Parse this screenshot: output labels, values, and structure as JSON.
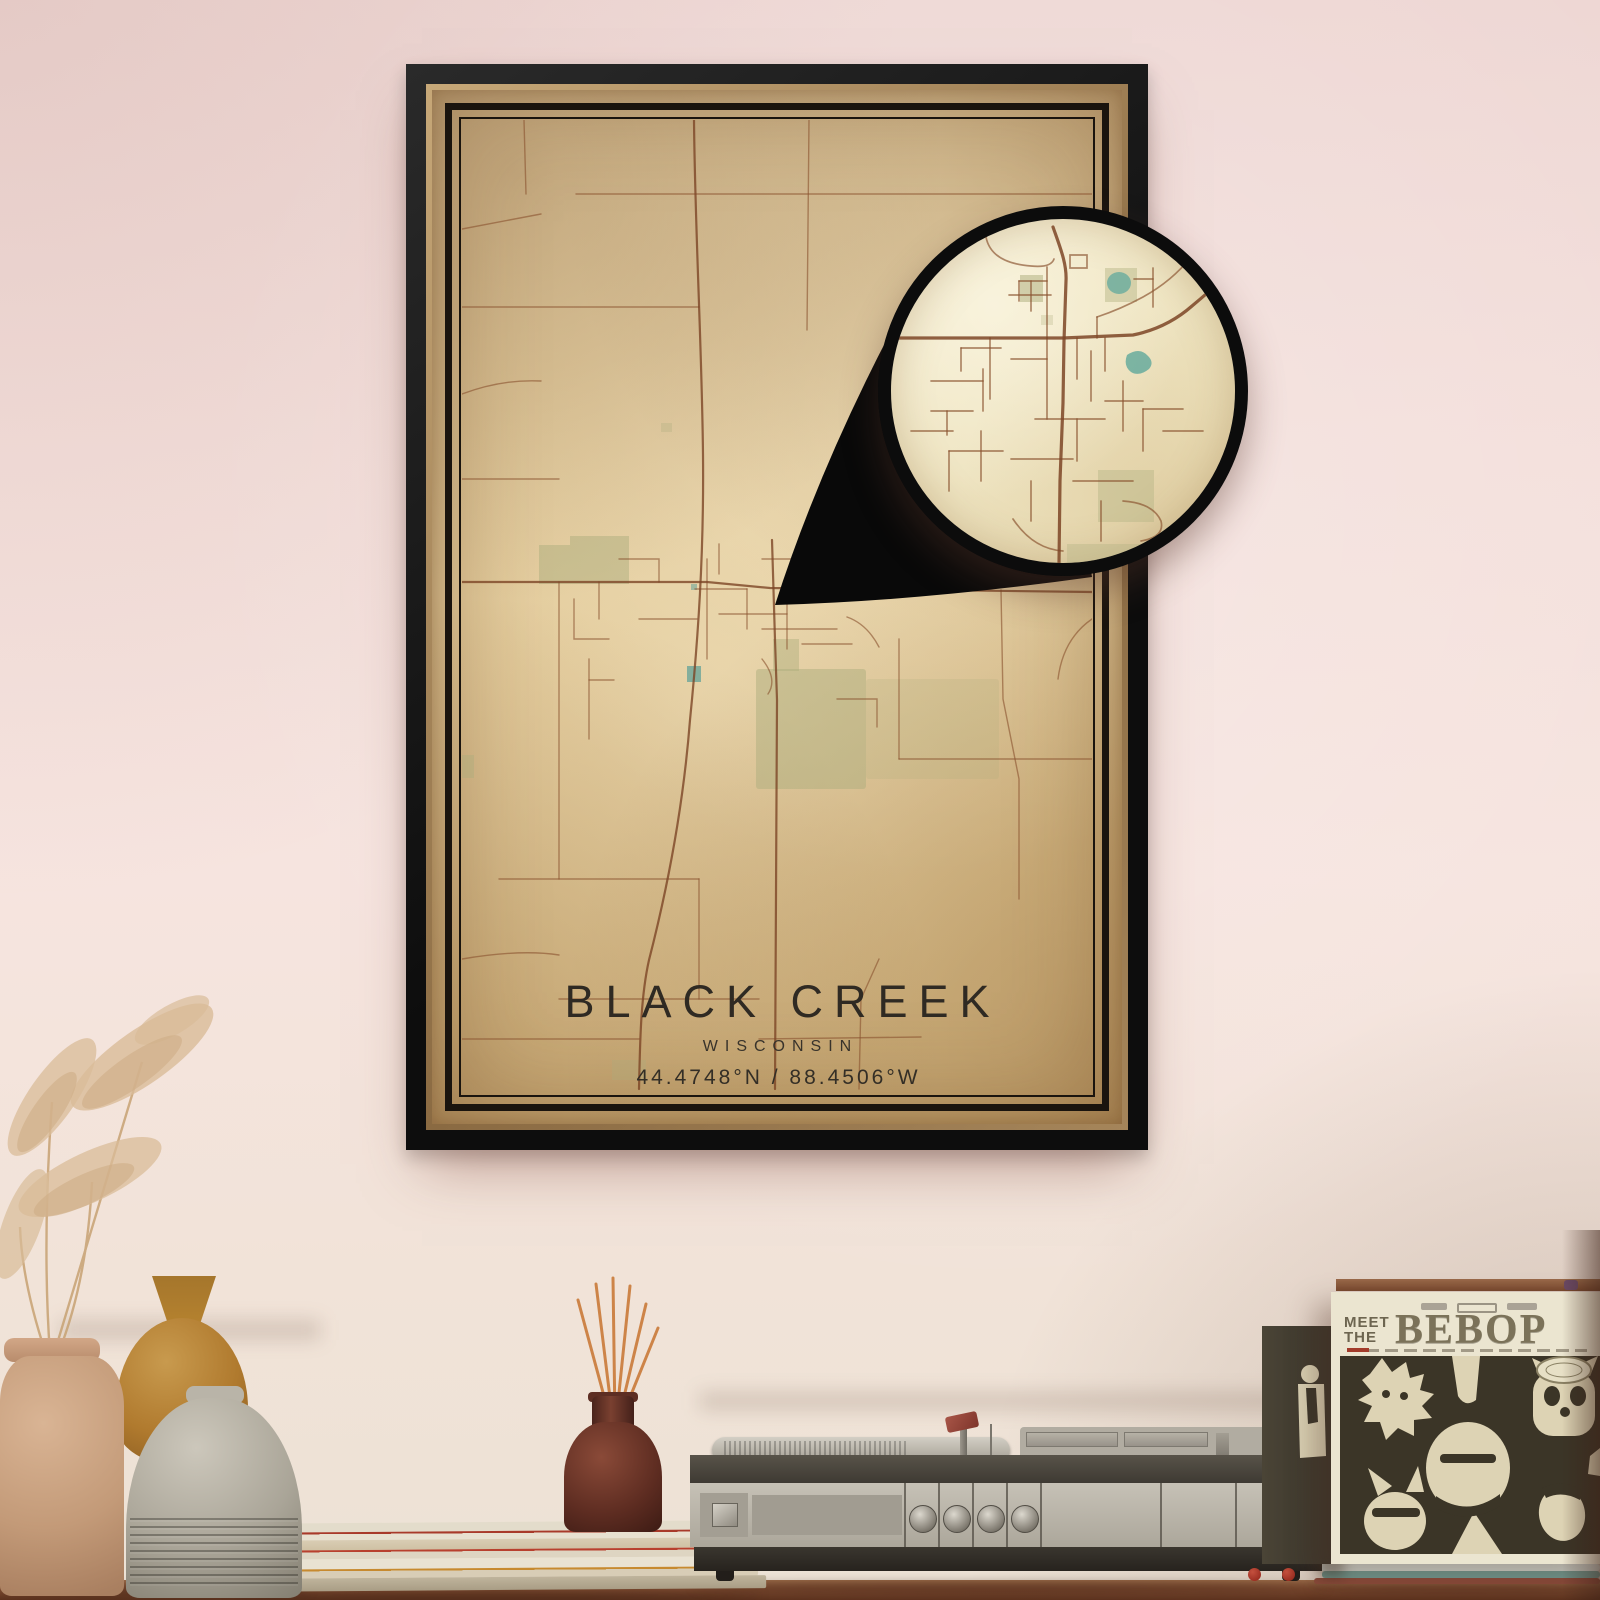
{
  "poster": {
    "title": "BLACK CREEK",
    "subtitle": "WISCONSIN",
    "coordinates": "44.4748°N / 88.4506°W",
    "frame_color": "#141414",
    "trim_color": "#a98757",
    "paper_color": "#e2cd9f",
    "inner_border_color": "#1a140e",
    "road_color": "#8a5430",
    "highway_color": "#7c4526",
    "park_color": "#adad7d",
    "water_color": "#72a79a",
    "text_color": "#2f2a23"
  },
  "callout": {
    "ring_color": "#0c0c0c",
    "wedge_color": "#090909",
    "paper_color": "#f2e9cb"
  },
  "record_sleeve": {
    "meet": "MEET",
    "the": "THE",
    "bebop": "BEBOP",
    "cover_color": "#ebe5d0",
    "photo_color": "#3b3527",
    "title_color": "#6d6550"
  },
  "scene": {
    "wall_color": "#f3dfdb",
    "table_color": "#7c4a30",
    "player_body_color": "#bcb7ac",
    "diffuser_color": "#5d2c21",
    "reed_color": "#cd8448"
  }
}
